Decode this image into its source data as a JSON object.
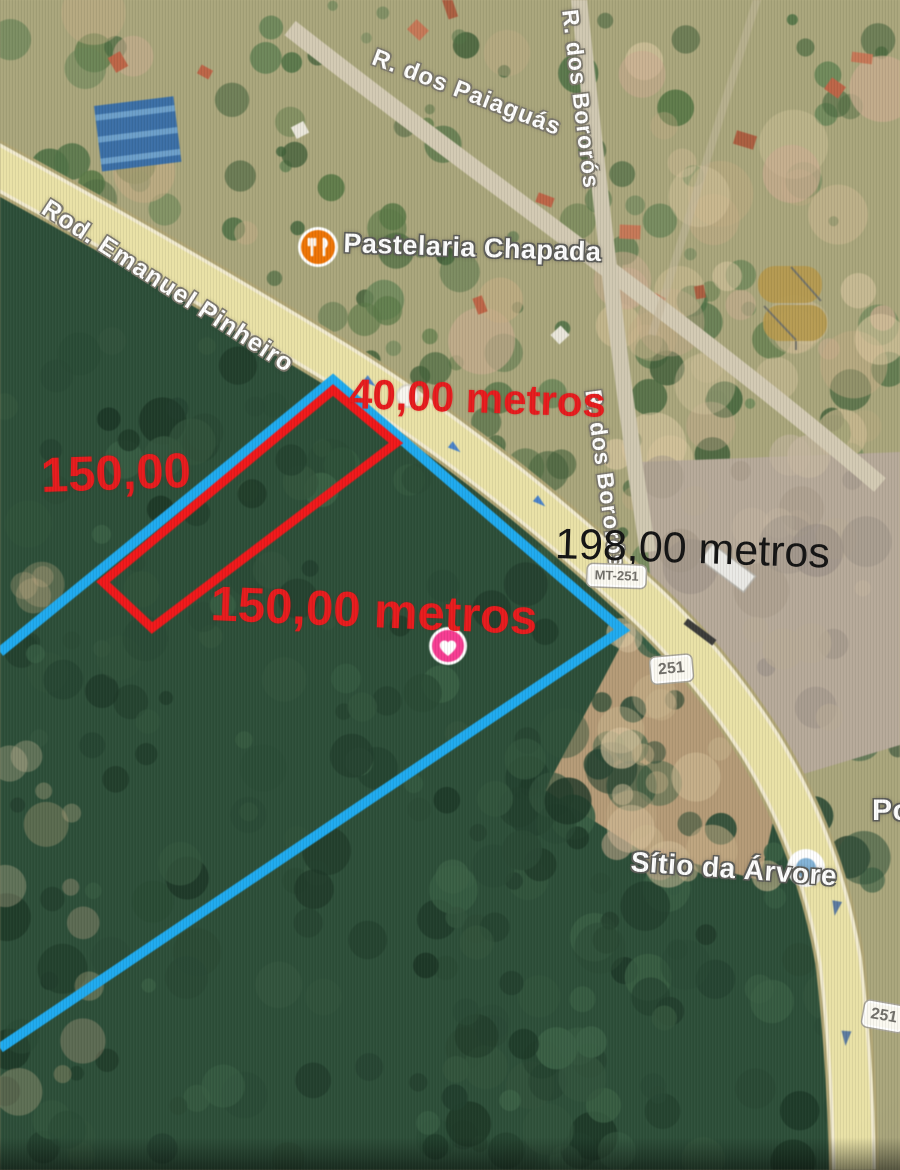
{
  "streets": {
    "highway": "Rod. Emanuel Pinheiro",
    "paiaguas": "R. dos Paiaguás",
    "bororos_top": "R. dos Bororós",
    "bororos_mid": "R. dos Bororós"
  },
  "shields": {
    "mt251": "MT-251",
    "s251_mid": "251",
    "s251_bottom": "251"
  },
  "pois": {
    "pastelaria": "Pastelaria Chapada",
    "sitio": "Sítio da Árvore",
    "partial_right": "Po"
  },
  "measurements": {
    "front": "40,00 metros",
    "left_side": "150,00",
    "bottom_side": "150,00 metros",
    "road_frontage": "198,00 metros"
  },
  "annotations": {
    "red_plot_color": "#e71b1d",
    "blue_boundary_color": "#25a8e9"
  },
  "markers": {
    "restaurant_icon_color": "#e8750c",
    "heart_icon_color": "#ee3f90",
    "place_dot_color": "#85b2d4",
    "watermark_color": "#b49a52"
  }
}
